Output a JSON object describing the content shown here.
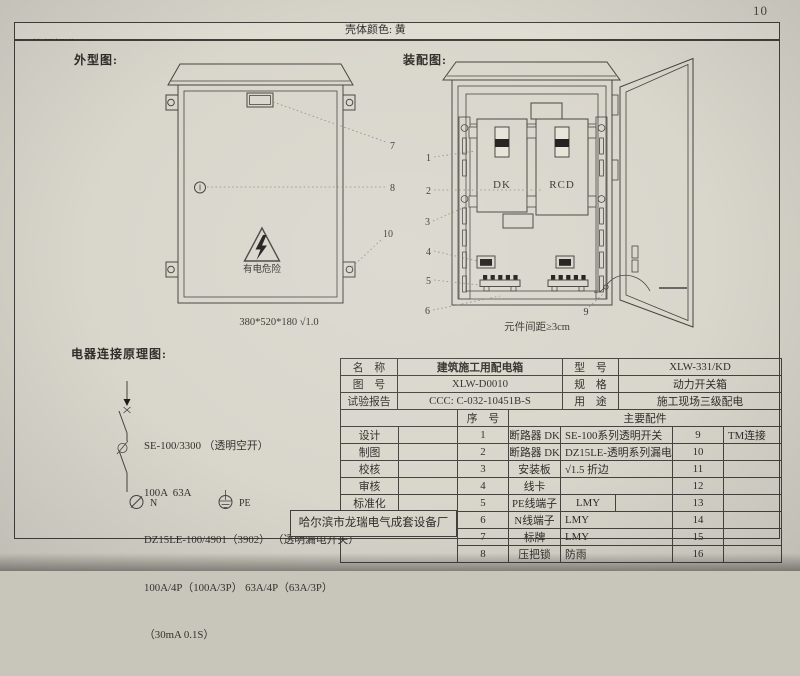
{
  "page_number": "10",
  "standards_bar": {
    "label": "执行标准: ",
    "items": [
      "1.GB 7251.4-2006",
      "2.JGJ46-2005",
      "3.GB6829"
    ],
    "shell_color": "壳体颜色: 黄"
  },
  "outline": {
    "title": "外型图:",
    "warning_text": "有电危险",
    "dimensions": "380*520*180 √1.0",
    "callouts": [
      "7",
      "8",
      "10"
    ]
  },
  "assembly": {
    "title": "装配图:",
    "breaker_left_label": "DK",
    "breaker_right_label": "RCD",
    "spacing_note": "元件间距≥3cm",
    "callouts": [
      "1",
      "2",
      "3",
      "4",
      "5",
      "6",
      "9"
    ]
  },
  "schematic": {
    "title": "电器连接原理图:",
    "spec_lines": [
      "SE-100/3300 （透明空开）",
      "100A  63A",
      "DZ15LE-100/4901（3902） （透明漏电开关）",
      "100A/4P（100A/3P） 63A/4P（63A/3P）",
      "（30mA 0.1S）"
    ],
    "neutral_label": "N",
    "earth_label": "PE"
  },
  "company": "哈尔滨市龙瑞电气成套设备厂",
  "info_table": {
    "rows": [
      {
        "l1": "名　称",
        "v1": "建筑施工用配电箱",
        "l2": "型　号",
        "v2": "XLW-331/KD"
      },
      {
        "l1": "图　号",
        "v1": "XLW-D0010",
        "l2": "规　格",
        "v2": "动力开关箱"
      },
      {
        "l1": "试验报告",
        "v1": "CCC: C-032-10451B-S",
        "l2": "用　途",
        "v2": "施工现场三级配电"
      }
    ]
  },
  "parts_table": {
    "seq_header": "序　号",
    "parts_header": "主要配件",
    "sign_labels": [
      "设计",
      "制图",
      "校核",
      "审核",
      "标准化",
      "日期"
    ],
    "rows": [
      {
        "seq": "1",
        "name": "断路器 DK",
        "desc": "SE-100系列透明开关",
        "num": "9",
        "note": "TM连接"
      },
      {
        "seq": "2",
        "name": "断路器 DK",
        "desc": "DZ15LE-透明系列漏电开关",
        "num": "10",
        "note": ""
      },
      {
        "seq": "3",
        "name": "安装板",
        "desc": "√1.5 折边",
        "num": "11",
        "note": ""
      },
      {
        "seq": "4",
        "name": "线卡",
        "desc": "",
        "num": "12",
        "note": ""
      },
      {
        "seq": "5",
        "name": "PE线端子",
        "desc": "LMY",
        "num": "13",
        "note": ""
      },
      {
        "seq": "6",
        "name": "N线端子",
        "desc": "LMY",
        "num": "14",
        "note": ""
      },
      {
        "seq": "7",
        "name": "标牌",
        "desc": "LMY",
        "num": "15",
        "note": ""
      },
      {
        "seq": "8",
        "name": "压把锁",
        "desc": "防雨",
        "num": "16",
        "note": ""
      }
    ]
  },
  "colors": {
    "paper": "#d9d6cc",
    "line": "#45433e",
    "ink": "#2f2e2a"
  }
}
